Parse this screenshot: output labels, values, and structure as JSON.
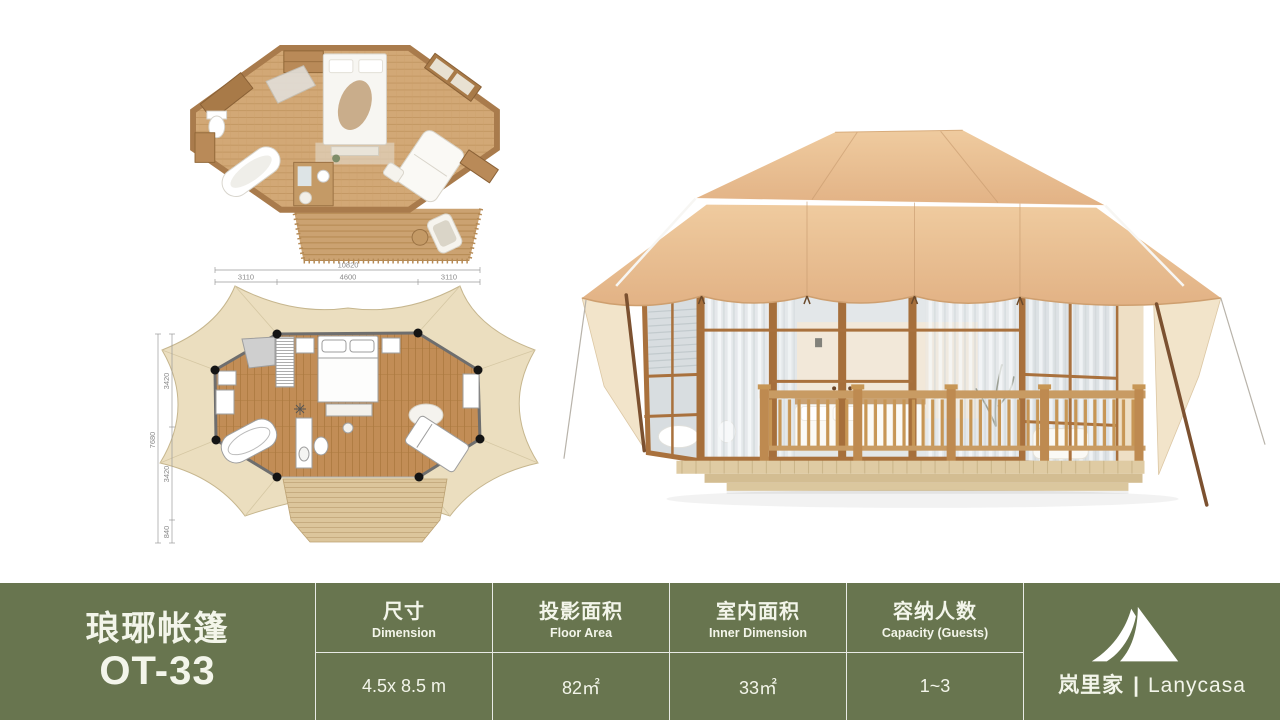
{
  "product": {
    "name_cn": "琅琊帐篷",
    "model": "OT-33"
  },
  "spec_bar": {
    "background": "#68754F",
    "text_color": "#F3F5EA",
    "columns": [
      {
        "label_cn": "尺寸",
        "label_en": "Dimension",
        "value": "4.5x 8.5 m"
      },
      {
        "label_cn": "投影面积",
        "label_en": "Floor Area",
        "value": "82㎡"
      },
      {
        "label_cn": "室内面积",
        "label_en": "Inner Dimension",
        "value": "33㎡"
      },
      {
        "label_cn": "容纳人数",
        "label_en": "Capacity (Guests)",
        "value": "1~3"
      }
    ]
  },
  "brand": {
    "name_cn": "岚里家",
    "separator": "|",
    "name_en": "Lanycasa",
    "icon": "tent-icon"
  },
  "plan2d": {
    "dims_top": {
      "overall": "10820",
      "seg_left": "3110",
      "seg_mid": "4600",
      "seg_right": "3110"
    },
    "dims_left": {
      "overall": "7680",
      "seg_top": "3420",
      "seg_mid": "3420",
      "seg_bottom": "840"
    }
  },
  "colors": {
    "roof_canvas": "#E6BD92",
    "canvas_light": "#F2E4CA",
    "wood_frame": "#A9713D",
    "railing_wood": "#C79655",
    "deck_wood": "#DFCBA3",
    "plan_canvas": "#EBDEBF",
    "plan_floor": "#C28D56",
    "glass": "#D9DEE1",
    "interior_wall": "#F2E8D8"
  }
}
